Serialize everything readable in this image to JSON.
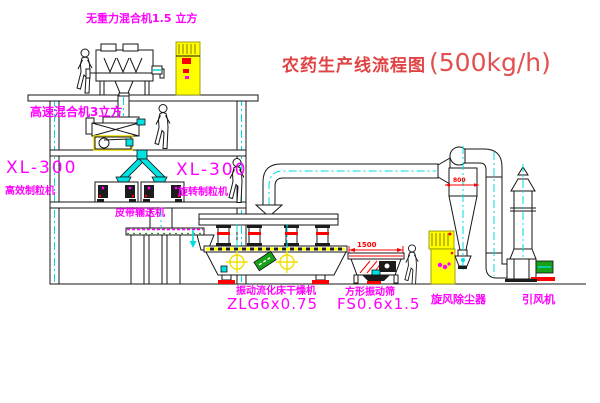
{
  "title": {
    "text": "农药生产线流程图",
    "capacity": "(500kg/h)"
  },
  "equipment_labels": {
    "gravity_mixer": "无重力混合机1.5 立方",
    "high_speed_mixer": "高速混合机3立方",
    "granulator_left_model": "XL-300",
    "granulator_left_name": "高效制粒机",
    "granulator_right_model": "XL-300",
    "granulator_right_name": "旋转制粒机",
    "belt_conveyor": "皮带输送机",
    "fluid_bed_dryer_name": "振动流化床干燥机",
    "fluid_bed_dryer_model": "ZLG6x0.75",
    "vibrating_screen_name": "方形振动筛",
    "vibrating_screen_model": "FS0.6x1.5",
    "cyclone": "旋风除尘器",
    "induced_draft_fan": "引风机"
  },
  "dimensions": {
    "screen_length": "1500",
    "cyclone_diameter": "800"
  },
  "colors": {
    "label_magenta": "#ff00ff",
    "title_red": "#e04343",
    "dimension_red": "#ff0000",
    "centerline_cyan": "#00dede",
    "cabinet_yellow": "#ffff00",
    "line_black": "#161616",
    "motor_green": "#18a018"
  }
}
